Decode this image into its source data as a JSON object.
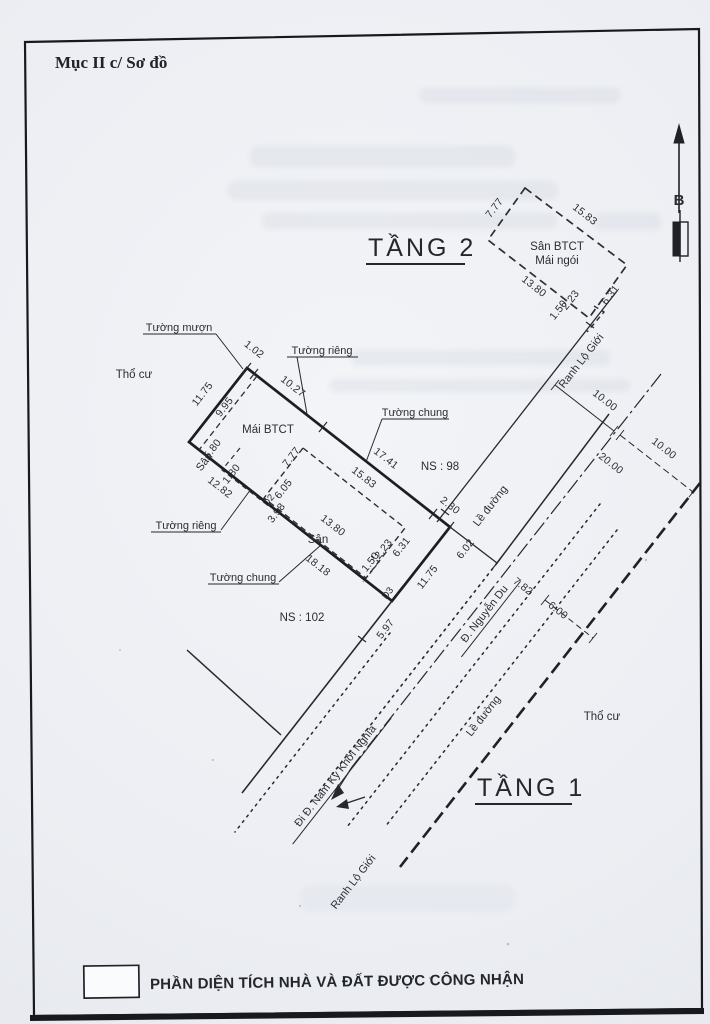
{
  "header": {
    "title": "Mục II c/ Sơ đồ"
  },
  "compass": {
    "north": "B"
  },
  "floor2": {
    "heading": "TẦNG 2",
    "san_btct": "Sân BTCT",
    "mai_ngoi": "Mái ngói"
  },
  "san_dims": {
    "short": "7.77",
    "long": "15.83",
    "bottom": "13.80",
    "notch_a": "2.23",
    "notch_b": "1.50",
    "side": "6.31"
  },
  "floor1": {
    "heading": "TẦNG 1",
    "mai_btct": "Mái BTCT",
    "san": "Sân",
    "dims": {
      "jog": "1.02",
      "side": "11.75",
      "left_inner": "9.95",
      "top1": "10.27",
      "top2": "17.41",
      "right_top": "2.30",
      "to_curb": "6.02",
      "ext": "5.97",
      "bottom1": "12.82",
      "bottom2": "18.18",
      "sy1": "5.80",
      "sy2": "1.80",
      "sy3": "6.05",
      "sy4": "3.98"
    },
    "markers": {
      "d2": "D2",
      "d3": "D3"
    },
    "walls": {
      "muon": "Tường mượn",
      "rieng": "Tường riêng",
      "chung": "Tường chung"
    },
    "neighbors": {
      "ns98": "NS : 98",
      "ns102": "NS : 102"
    }
  },
  "land": {
    "tho_cu": "Thổ cư"
  },
  "roads": {
    "ranh_lo_gioi": "Ranh Lộ Giới",
    "le_duong": "Lề đường",
    "nguyen_du": "Đ. Nguyễn Du",
    "nguyen_du_width": "7.82",
    "nkkn": "Đi Đ. Nam Kỳ Khởi Nghĩa",
    "half_width": "10.00",
    "full_width": "20.00",
    "offset": "6.00"
  },
  "legend": {
    "label": "PHẦN DIỆN TÍCH NHÀ VÀ ĐẤT ĐƯỢC CÔNG NHẬN"
  }
}
